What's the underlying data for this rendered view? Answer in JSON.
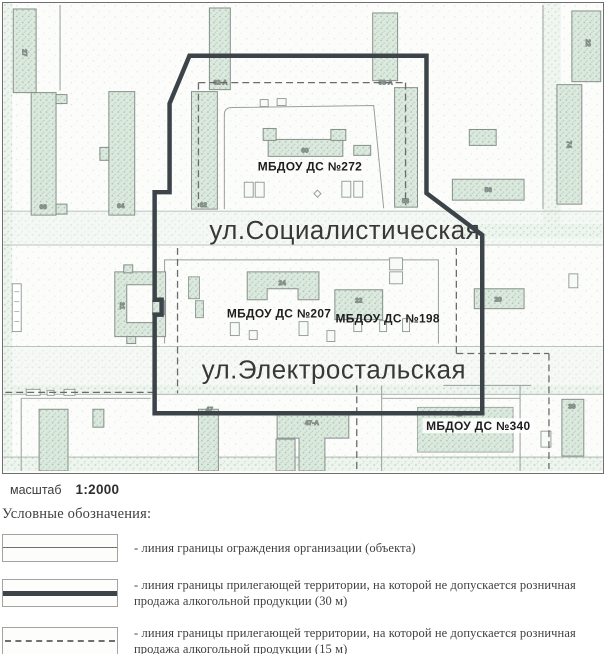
{
  "map": {
    "streets": {
      "socialisticheskaya": "ул.Социалистическая",
      "elektrostalskaya": "ул.Электростальская"
    },
    "facilities": {
      "ds272": "МБДОУ ДС №272",
      "ds207": "МБДОУ ДС №207",
      "ds198": "МБДОУ ДС №198",
      "ds340": "МБДОУ ДС №340"
    },
    "buildings": {
      "b27": "27",
      "b66": "66",
      "b64": "64",
      "b62": "62",
      "b62a": "62-А",
      "b58a": "58-А",
      "b58": "58",
      "b22r": "22",
      "b74": "74",
      "b56": "56",
      "b60": "60",
      "b24": "24",
      "b22c": "22",
      "b31": "31",
      "b20": "20",
      "b41": "41",
      "b39": "39",
      "b47": "47",
      "b47a": "47-А"
    },
    "colors": {
      "boundary_30m": "#3c4349",
      "boundary_15m": "#6b6b6b",
      "fence": "#98a09b",
      "building_fill": "#dde9dd"
    }
  },
  "scale": {
    "label": "масштаб",
    "value": "1:2000"
  },
  "legend": {
    "title": "Условные обозначения:",
    "items": [
      {
        "text": "- линия границы ограждения организации (объекта)"
      },
      {
        "text": "- линия границы прилегающей территории, на которой не допускается розничная продажа алкогольной продукции (30 м)"
      },
      {
        "text": "- линия границы прилегающей территории, на которой не допускается розничная продажа алкогольной продукции (15 м)"
      }
    ]
  }
}
